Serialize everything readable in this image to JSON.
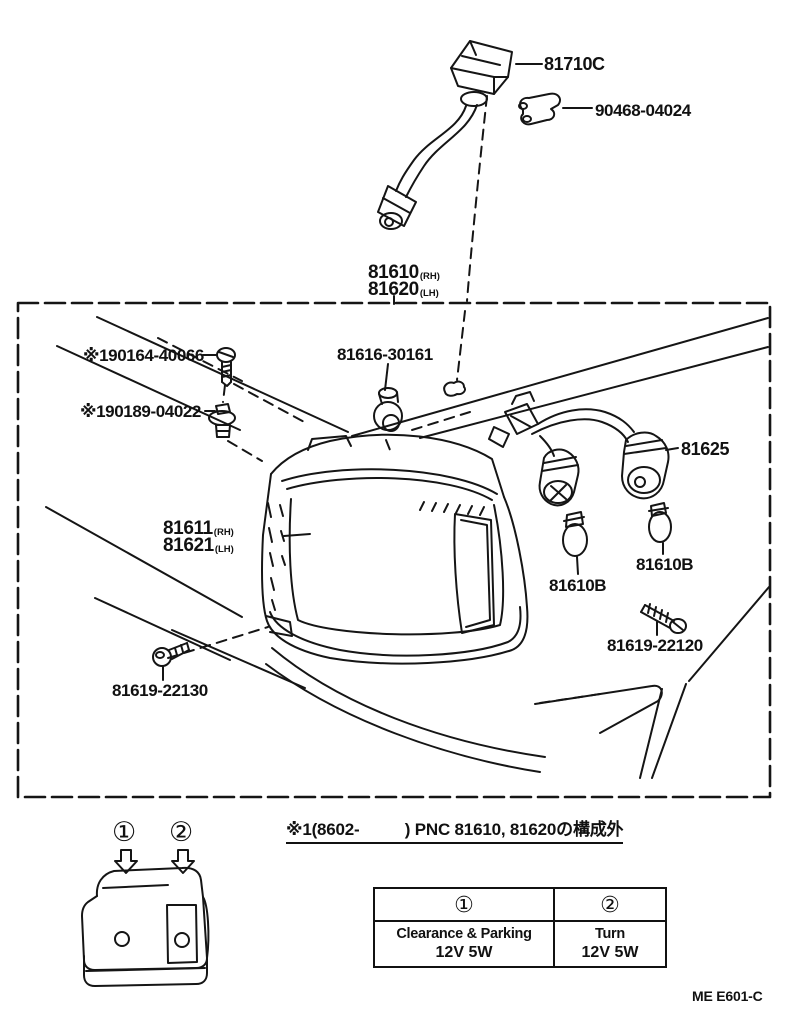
{
  "figure": {
    "doc_code": "ME E601-C",
    "note": "※1(8602-          ) PNC 81610, 81620の構成外"
  },
  "labels": {
    "marker_lamp": "81710C",
    "clamp": "90468-04024",
    "lamp_assy": {
      "line1_num": "81610",
      "line1_side": "(RH)",
      "line2_num": "81620",
      "line2_side": "(LH)"
    },
    "screw_upper": "※190164-40066",
    "grommet": "※190189-04022",
    "socket_single": "81616-30161",
    "wire_harness": "81625",
    "lens": {
      "line1_num": "81611",
      "line1_side": "(RH)",
      "line2_num": "81621",
      "line2_side": "(LH)"
    },
    "bulb_left": "81610B",
    "bulb_right": "81610B",
    "screw_lower_right": "81619-22120",
    "screw_lower_left": "81619-22130"
  },
  "inset": {
    "marker_1": "①",
    "marker_2": "②"
  },
  "legend_table": {
    "columns": [
      {
        "header": "①",
        "name": "Clearance & Parking",
        "spec": "12V 5W"
      },
      {
        "header": "②",
        "name": "Turn",
        "spec": "12V 5W"
      }
    ]
  }
}
